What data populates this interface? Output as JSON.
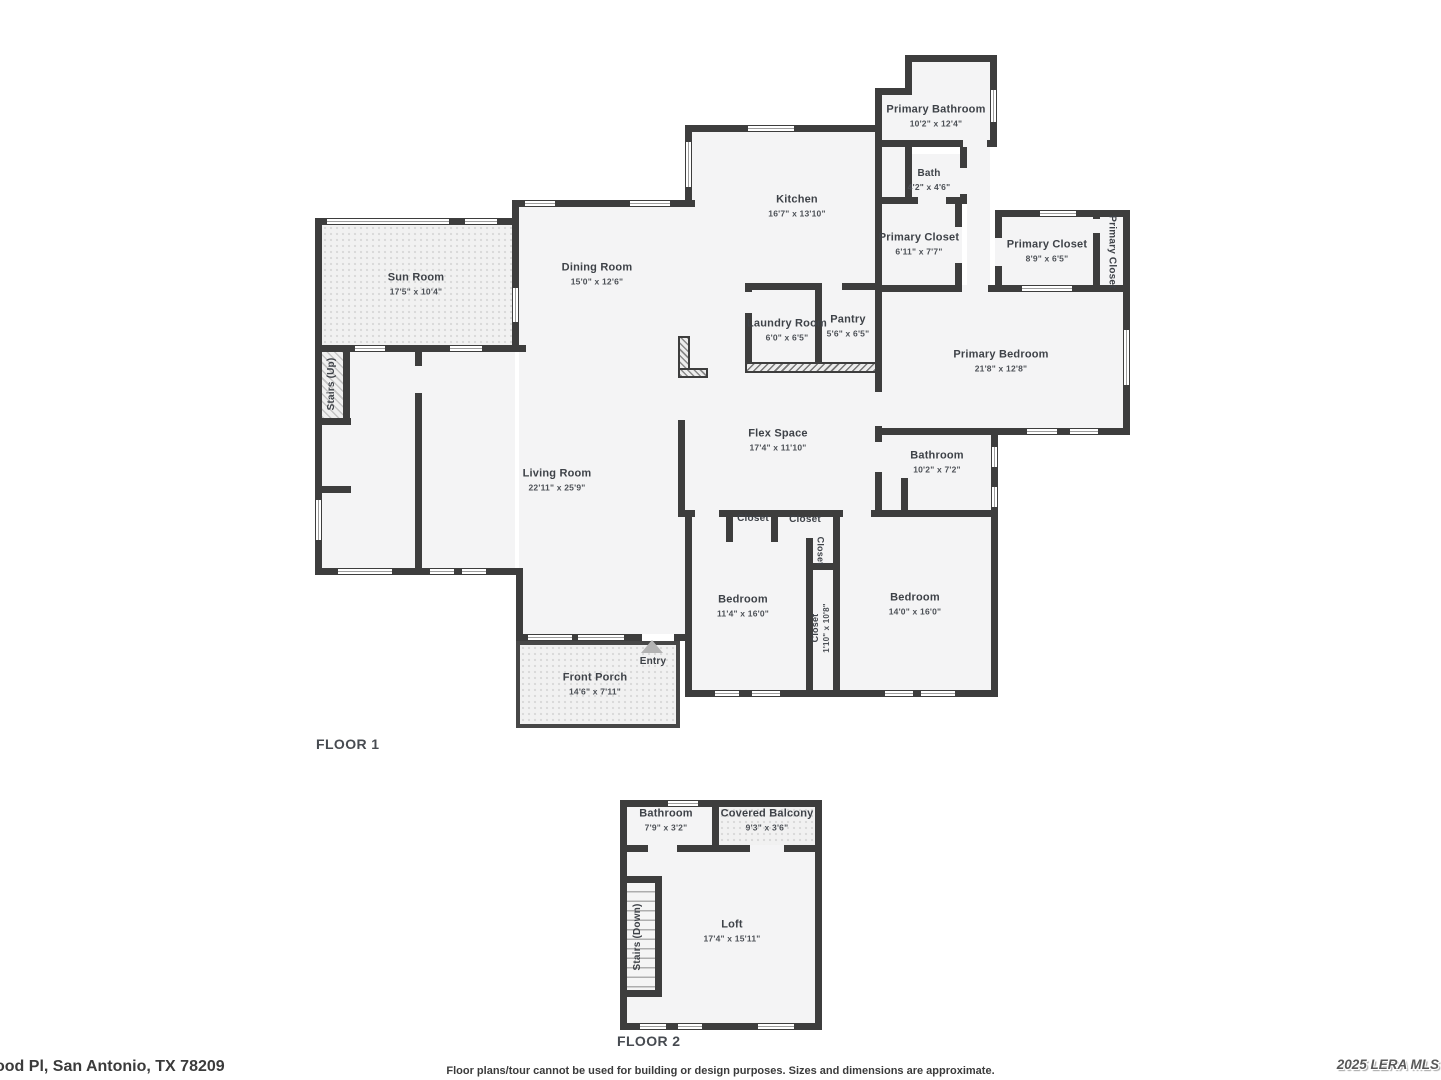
{
  "floor1": {
    "label": "FLOOR 1",
    "sun_room": {
      "name": "Sun Room",
      "dims": "17'5\" x 10'4\""
    },
    "dining_room": {
      "name": "Dining Room",
      "dims": "15'0\" x 12'6\""
    },
    "kitchen": {
      "name": "Kitchen",
      "dims": "16'7\" x 13'10\""
    },
    "primary_bathroom": {
      "name": "Primary Bathroom",
      "dims": "10'2\" x 12'4\""
    },
    "bath": {
      "name": "Bath",
      "dims": "4'2\" x 4'6\""
    },
    "primary_closet_a": {
      "name": "Primary Closet",
      "dims": "6'11\" x 7'7\""
    },
    "primary_closet_b": {
      "name": "Primary Closet",
      "dims": "8'9\" x 6'5\""
    },
    "primary_closet_c": {
      "name": "Primary Closet"
    },
    "laundry_room": {
      "name": "Laundry Room",
      "dims": "6'0\" x 6'5\""
    },
    "pantry": {
      "name": "Pantry",
      "dims": "5'6\" x 6'5\""
    },
    "primary_bedroom": {
      "name": "Primary Bedroom",
      "dims": "21'8\" x 12'8\""
    },
    "flex_space": {
      "name": "Flex Space",
      "dims": "17'4\" x 11'10\""
    },
    "bathroom": {
      "name": "Bathroom",
      "dims": "10'2\" x 7'2\""
    },
    "living_room": {
      "name": "Living Room",
      "dims": "22'11\" x 25'9\""
    },
    "stairs_up": {
      "name": "Stairs (Up)"
    },
    "closet_a": {
      "name": "Closet"
    },
    "closet_b": {
      "name": "Closet"
    },
    "closet_c": {
      "name": "Closet"
    },
    "closet_d": {
      "name": "Closet",
      "dims": "1'10\" x 10'8\""
    },
    "bedroom_a": {
      "name": "Bedroom",
      "dims": "11'4\" x 16'0\""
    },
    "bedroom_b": {
      "name": "Bedroom",
      "dims": "14'0\" x 16'0\""
    },
    "front_porch": {
      "name": "Front Porch",
      "dims": "14'6\" x 7'11\""
    },
    "entry": {
      "name": "Entry"
    }
  },
  "floor2": {
    "label": "FLOOR 2",
    "bathroom": {
      "name": "Bathroom",
      "dims": "7'9\" x 3'2\""
    },
    "covered_balcony": {
      "name": "Covered Balcony",
      "dims": "9'3\" x 3'6\""
    },
    "loft": {
      "name": "Loft",
      "dims": "17'4\" x 15'11\""
    },
    "stairs_down": {
      "name": "Stairs (Down)"
    }
  },
  "footer": {
    "address": "ood Pl, San Antonio, TX 78209",
    "disclaimer": "Floor plans/tour cannot be used for building or design purposes. Sizes and dimensions are approximate.",
    "watermark": "2025 LERA MLS"
  },
  "colors": {
    "wall": "#3d3d3d",
    "floor_fill": "#f4f4f5",
    "entry_arrow": "#b3b3b3"
  }
}
